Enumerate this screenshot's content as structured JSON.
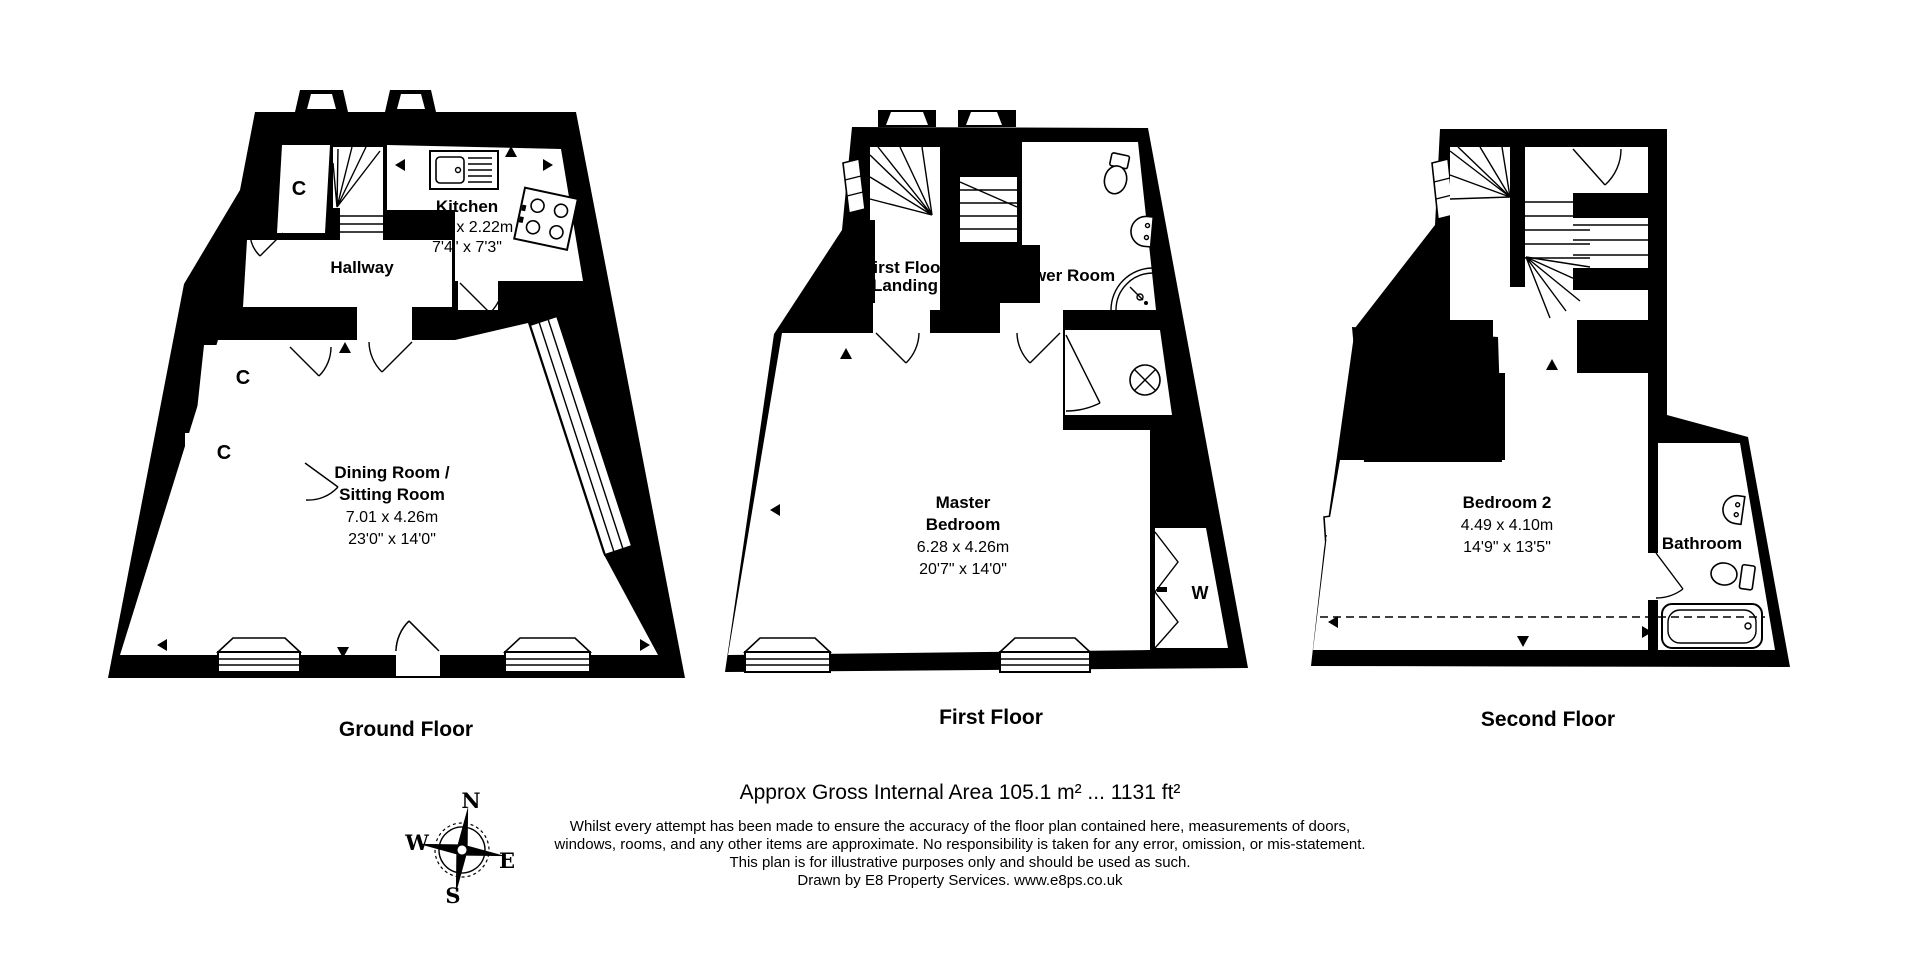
{
  "floorplan": {
    "ground": {
      "caption": "Ground Floor",
      "kitchen_name": "Kitchen",
      "kitchen_dim_m": "2.23 x 2.22m",
      "kitchen_dim_ft": "7'4\" x 7'3\"",
      "hallway": "Hallway",
      "closet": "C",
      "dining_name1": "Dining Room /",
      "dining_name2": "Sitting Room",
      "dining_dim_m": "7.01 x 4.26m",
      "dining_dim_ft": "23'0\" x 14'0\""
    },
    "first": {
      "caption": "First Floor",
      "landing1": "First Floor",
      "landing2": "Landing",
      "shower": "Shower Room",
      "master1": "Master",
      "master2": "Bedroom",
      "master_dim_m": "6.28 x 4.26m",
      "master_dim_ft": "20'7\" x 14'0\"",
      "wardrobe": "W"
    },
    "second": {
      "caption": "Second Floor",
      "bedroom_name": "Bedroom 2",
      "bedroom_dim_m": "4.49 x 4.10m",
      "bedroom_dim_ft": "14'9\" x 13'5\"",
      "bathroom": "Bathroom"
    }
  },
  "compass": {
    "north": "N",
    "east": "E",
    "south": "S",
    "west": "W"
  },
  "footer": {
    "area": "Approx Gross Internal Area 105.1 m² ... 1131 ft²",
    "disclaimer_line1": "Whilst every attempt has been made to ensure the accuracy of the floor plan contained here, measurements of doors,",
    "disclaimer_line2": "windows, rooms, and any other items are approximate. No responsibility is taken for any error, omission, or mis-statement.",
    "disclaimer_line3": "This plan is for illustrative purposes only and should be used as such.",
    "credit": "Drawn by E8 Property Services. www.e8ps.co.uk"
  },
  "colors": {
    "wall": "#000000",
    "background": "#ffffff"
  }
}
